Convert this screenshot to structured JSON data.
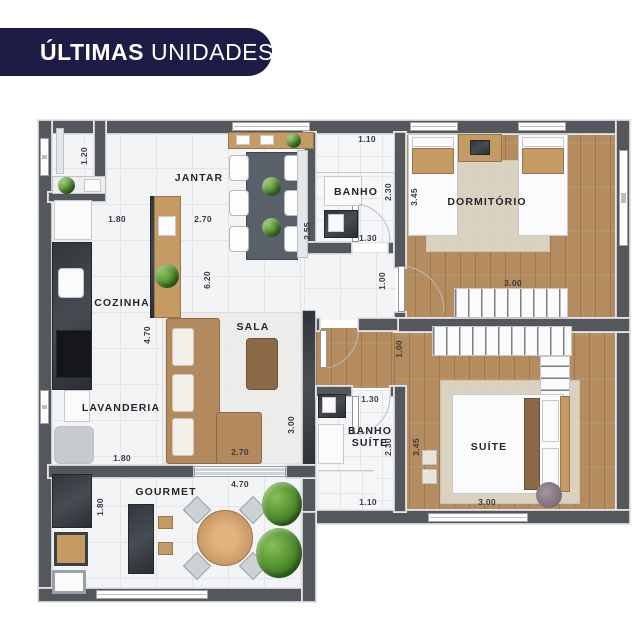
{
  "banner": {
    "bold_text": "ÚLTIMAS",
    "regular_text": "UNIDADES",
    "bg_color": "#1f1b47",
    "text_color": "#ffffff"
  },
  "rooms": {
    "jantar": "JANTAR",
    "cozinha": "COZINHA",
    "lavanderia": "LAVANDERIA",
    "sala": "SALA",
    "banho": "BANHO",
    "dormitorio": "DORMITÓRIO",
    "banho_suite_line1": "BANHO",
    "banho_suite_line2": "SUÍTE",
    "suite": "SUÍTE",
    "gourmet": "GOURMET"
  },
  "dims": [
    "1.20",
    "1.80",
    "2.70",
    "2.55",
    "6.20",
    "1.10",
    "2.30",
    "1.30",
    "3.45",
    "3.00",
    "1.00",
    "1.00",
    "4.70",
    "1.80",
    "2.70",
    "3.00",
    "4.70",
    "1.30",
    "2.30",
    "1.10",
    "3.45",
    "3.00",
    "1.80"
  ],
  "colors": {
    "banner_bg": "#1f1b47",
    "wall_gray": "#54575c",
    "wood_floor": "#b58c5f",
    "tile_floor": "#f3f4f6",
    "plant_green": "#4a8a2b",
    "counter_dark": "#32363d"
  }
}
